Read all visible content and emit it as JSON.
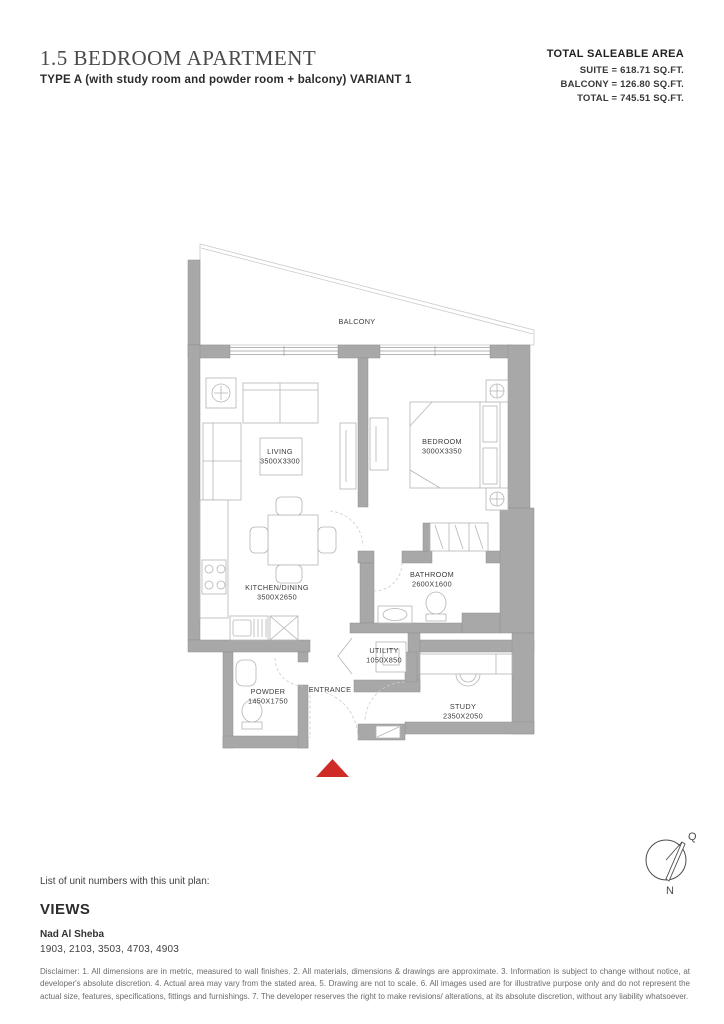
{
  "header": {
    "title": "1.5 BEDROOM APARTMENT",
    "subtitle": "TYPE A (with study room and powder room + balcony) VARIANT 1"
  },
  "saleable_area": {
    "heading": "TOTAL SALEABLE AREA",
    "lines": [
      "SUITE = 618.71 SQ.FT.",
      "BALCONY = 126.80 SQ.FT.",
      "TOTAL = 745.51 SQ.FT."
    ]
  },
  "plan": {
    "balcony_label": "BALCONY",
    "entrance_label": "ENTRANCE",
    "rooms": [
      {
        "name": "LIVING",
        "dims": "3500X3300"
      },
      {
        "name": "BEDROOM",
        "dims": "3000X3350"
      },
      {
        "name": "KITCHEN/DINING",
        "dims": "3500X2650"
      },
      {
        "name": "BATHROOM",
        "dims": "2600X1600"
      },
      {
        "name": "UTILITY",
        "dims": "1050X850"
      },
      {
        "name": "POWDER",
        "dims": "1450X1750"
      },
      {
        "name": "STUDY",
        "dims": "2350X2050"
      }
    ]
  },
  "compass": {
    "north_label": "N",
    "qibla_label": "Q"
  },
  "unit_list": {
    "caption": "List of unit numbers with this unit plan:",
    "views_title": "VIEWS",
    "location": "Nad Al Sheba",
    "units": "1903, 2103, 3503, 4703, 4903"
  },
  "disclaimer": "Disclaimer: 1. All dimensions are in metric, measured to wall finishes. 2. All materials, dimensions & drawings are approximate. 3. Information is subject to change without notice, at developer's absolute discretion. 4. Actual area may vary from the stated area. 5. Drawing are not to scale. 6. All images used are for illustrative purpose only and do not represent the actual size, features, specifications, fittings and furnishings. 7. The developer reserves the right to make revisions/ alterations, at its absolute discretion, without any liability whatsoever.",
  "colors": {
    "wall": "#a8a8a8",
    "accent_red": "#cf2b27"
  }
}
